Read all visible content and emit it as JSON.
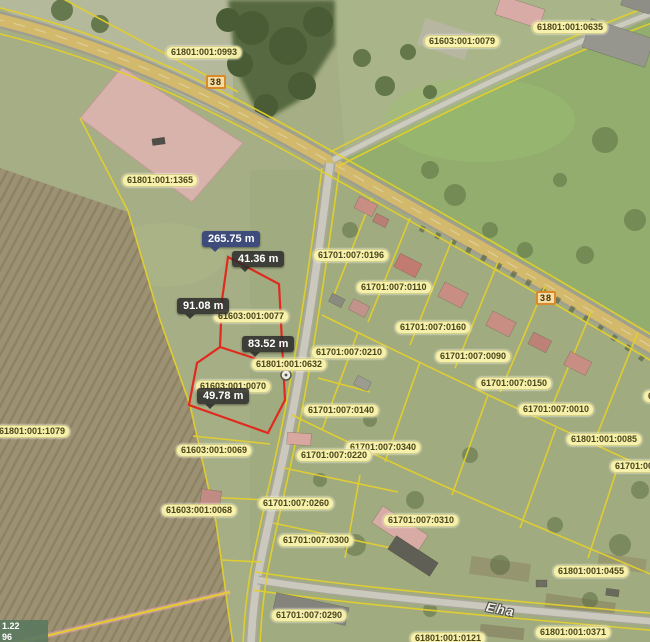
{
  "map": {
    "colors": {
      "selected_parcel_outline": "#e02a1e",
      "cadastral_line": "#e3cf2e",
      "parcel_label_bg": "#fcf6b0",
      "measure_total_bg": "#39487c",
      "measure_segment_bg": "#2a2a2a",
      "road_badge_border": "#d98a2b",
      "road_fill": "#d3b96b"
    },
    "parcel_labels": [
      {
        "text": "61801:001:0993",
        "x": 166,
        "y": 46
      },
      {
        "text": "61603:001:0079",
        "x": 424,
        "y": 35
      },
      {
        "text": "61801:001:0635",
        "x": 532,
        "y": 21
      },
      {
        "text": "61801:001:1365",
        "x": 122,
        "y": 174
      },
      {
        "text": "61701:007:0196",
        "x": 313,
        "y": 249
      },
      {
        "text": "61701:007:0110",
        "x": 356,
        "y": 281
      },
      {
        "text": "61603:001:0077",
        "x": 213,
        "y": 310
      },
      {
        "text": "61701:007:0160",
        "x": 395,
        "y": 321
      },
      {
        "text": "61701:007:0210",
        "x": 311,
        "y": 346
      },
      {
        "text": "61701:007:0090",
        "x": 435,
        "y": 350
      },
      {
        "text": "61801:001:0632",
        "x": 251,
        "y": 358
      },
      {
        "text": "61701:007:0150",
        "x": 476,
        "y": 377
      },
      {
        "text": "61603:001:0070",
        "x": 195,
        "y": 380
      },
      {
        "text": "6",
        "x": 643,
        "y": 390
      },
      {
        "text": "61701:007:0010",
        "x": 518,
        "y": 403
      },
      {
        "text": "61701:007:0140",
        "x": 303,
        "y": 404
      },
      {
        "text": "61801:001:1079",
        "x": -6,
        "y": 425
      },
      {
        "text": "61801:001:0085",
        "x": 566,
        "y": 433
      },
      {
        "text": "61701:007:0340",
        "x": 345,
        "y": 441
      },
      {
        "text": "61603:001:0069",
        "x": 176,
        "y": 444
      },
      {
        "text": "61701:007:0220",
        "x": 296,
        "y": 449
      },
      {
        "text": "61701:00",
        "x": 610,
        "y": 460
      },
      {
        "text": "61701:007:0260",
        "x": 258,
        "y": 497
      },
      {
        "text": "61603:001:0068",
        "x": 161,
        "y": 504
      },
      {
        "text": "61701:007:0310",
        "x": 383,
        "y": 514
      },
      {
        "text": "61701:007:0300",
        "x": 278,
        "y": 534
      },
      {
        "text": "61801:001:0455",
        "x": 553,
        "y": 565
      },
      {
        "text": "61701:007:0290",
        "x": 271,
        "y": 609
      },
      {
        "text": "61801:001:0371",
        "x": 535,
        "y": 626
      },
      {
        "text": "61801:001:0121",
        "x": 410,
        "y": 632
      }
    ],
    "road_badges": [
      {
        "text": "38",
        "x": 206,
        "y": 75
      },
      {
        "text": "38",
        "x": 536,
        "y": 291
      }
    ],
    "measurements": [
      {
        "text": "265.75 m",
        "x": 202,
        "y": 231,
        "type": "total"
      },
      {
        "text": "41.36 m",
        "x": 232,
        "y": 251,
        "type": "segment"
      },
      {
        "text": "91.08 m",
        "x": 177,
        "y": 298,
        "type": "segment"
      },
      {
        "text": "83.52 m",
        "x": 242,
        "y": 336,
        "type": "segment"
      },
      {
        "text": "49.78 m",
        "x": 197,
        "y": 388,
        "type": "segment"
      }
    ],
    "street_label": {
      "text": "Eha"
    },
    "coordinate_readout": {
      "line1": "1.22",
      "line2": "96"
    }
  }
}
